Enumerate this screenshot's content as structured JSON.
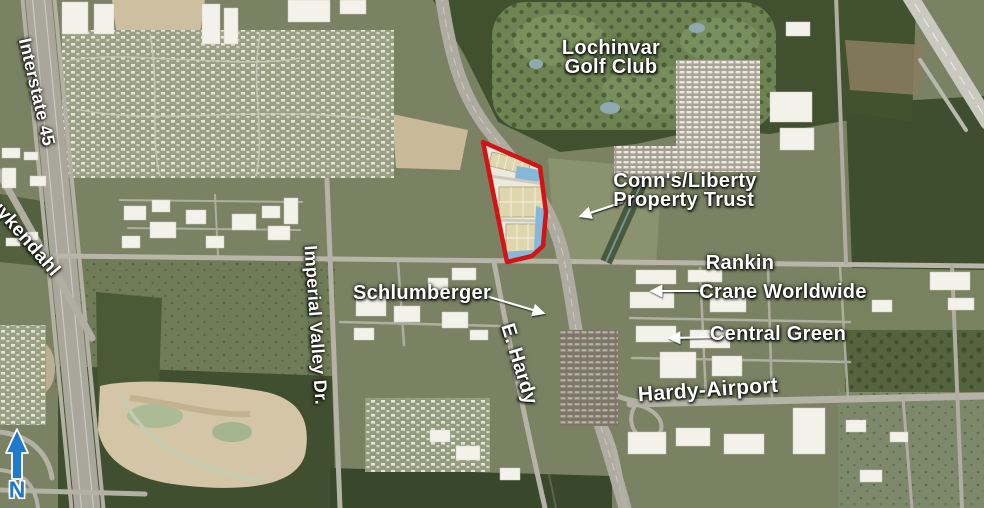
{
  "map": {
    "road_labels": {
      "interstate_45": "Interstate 45",
      "kuykendahl": "Kuykendahl",
      "imperial_valley_dr": "Imperial Valley Dr.",
      "e_hardy": "E. Hardy",
      "hardy_airport": "Hardy-Airport",
      "rankin": "Rankin"
    },
    "place_labels": {
      "golf_club_line1": "Lochinvar",
      "golf_club_line2": "Golf Club",
      "conns_line1": "Conn's/Liberty",
      "conns_line2": "Property Trust",
      "crane_worldwide": "Crane Worldwide",
      "central_green": "Central Green",
      "schlumberger": "Schlumberger"
    },
    "north_arrow": {
      "label": "N",
      "color": "#1f7ace"
    },
    "parcel": {
      "outline_color": "#d21414"
    },
    "colors": {
      "label_text": "#ffffff",
      "callout_arrow": "#ffffff",
      "water": "#85b8d9"
    }
  }
}
